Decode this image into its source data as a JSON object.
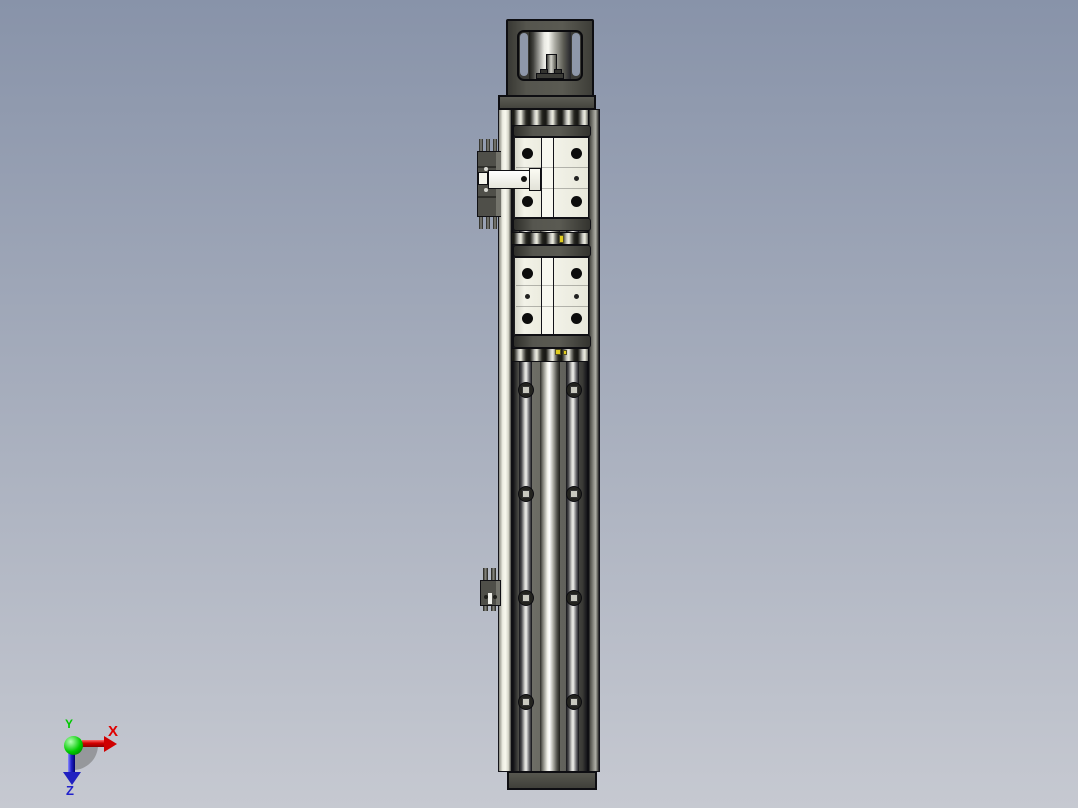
{
  "scene": {
    "viewport_label": "3D CAD viewport - vertical linear actuator module, front view",
    "background_top": "#8893a9",
    "background_bottom": "#c6c9d1"
  },
  "triad": {
    "x_label": "X",
    "y_label": "Y",
    "z_label": "Z",
    "x_color": "#e00000",
    "y_color": "#00c800",
    "z_color": "#2121cc"
  },
  "model": {
    "colors": {
      "frame_gray": "#50504a",
      "cap_gray": "#4a4a45",
      "ivory_white": "#efefe5",
      "channel_gray": "#5d5d56",
      "window_slot_blue": "#8e97a9",
      "nut_gray": "#c9c9bf",
      "grease_yellow": "#e0cc1e"
    },
    "bolt_rows_y": [
      390,
      494,
      598,
      702
    ],
    "bolt_cols_x": [
      526,
      574
    ],
    "carriages": [
      {
        "cap_top_y": 125,
        "body_y": 137,
        "body_h": 81
      },
      {
        "cap_top_y": 245,
        "body_y": 257,
        "body_h": 78
      }
    ],
    "roller_rows": [
      {
        "y": 109,
        "h": 17
      },
      {
        "y": 232,
        "h": 13
      },
      {
        "y": 348,
        "h": 14
      }
    ],
    "yellow_details": [
      {
        "x": 559,
        "y": 235,
        "w": 5,
        "h": 8
      },
      {
        "x": 555,
        "y": 349,
        "w": 6,
        "h": 6
      },
      {
        "x": 563,
        "y": 350,
        "w": 4,
        "h": 5
      }
    ],
    "upper_sensor_pins_x": [
      479,
      486,
      493
    ],
    "lower_sensor_pins_x": [
      483,
      491
    ],
    "flange_screws_x": [
      511,
      581
    ],
    "plate_screws_x": [
      515,
      585
    ]
  }
}
